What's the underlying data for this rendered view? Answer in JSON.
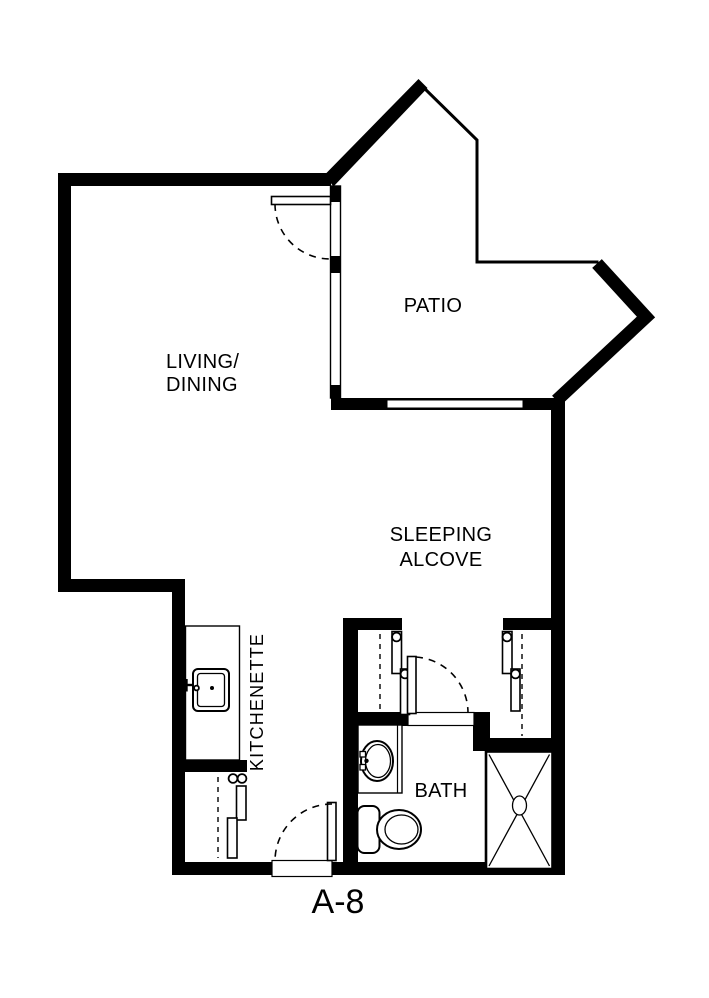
{
  "unit_label": "A-8",
  "plan": {
    "background_color": "#ffffff",
    "wall_color": "#000000",
    "rooms": {
      "living_dining": {
        "line1": "LIVING/",
        "line2": "DINING"
      },
      "patio": {
        "label": "PATIO"
      },
      "sleeping_alcove": {
        "line1": "SLEEPING",
        "line2": "ALCOVE"
      },
      "kitchenette": {
        "label": "KITCHENETTE"
      },
      "bath": {
        "label": "BATH"
      }
    },
    "fixtures": [
      "kitchen-sink",
      "bathroom-sink",
      "toilet",
      "shower",
      "closet-rod",
      "swing-door",
      "sliding-closet-door",
      "window"
    ]
  }
}
